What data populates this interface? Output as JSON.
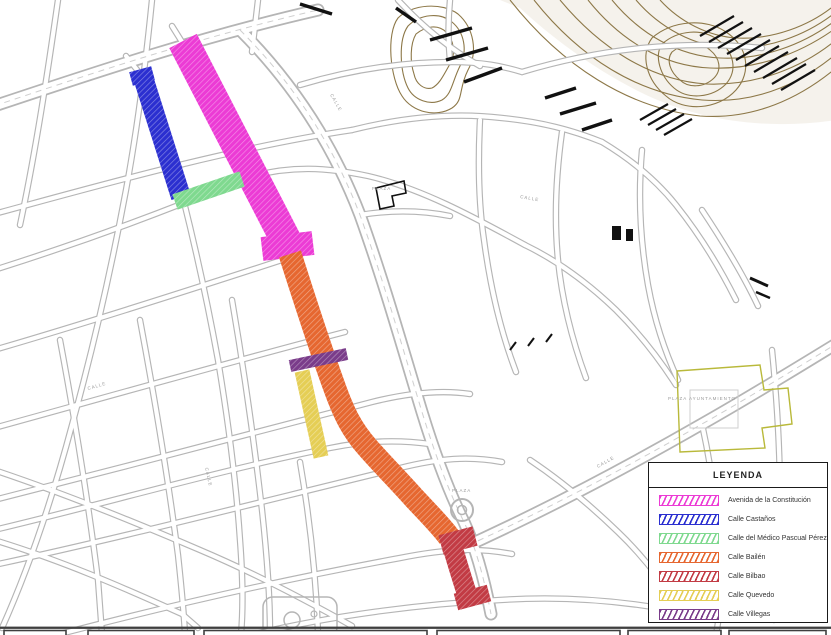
{
  "legend": {
    "title": "LEYENDA",
    "entries": [
      {
        "label": "Avenida de la Constitución",
        "color": "#EC3BD5"
      },
      {
        "label": "Calle Castaños",
        "color": "#2B2FD0"
      },
      {
        "label": "Calle del Médico Pascual Pérez",
        "color": "#7FD98F"
      },
      {
        "label": "Calle Bailén",
        "color": "#E66730"
      },
      {
        "label": "Calle Bilbao",
        "color": "#C23B44"
      },
      {
        "label": "Calle Quevedo",
        "color": "#E5CE55"
      },
      {
        "label": "Calle Villegas",
        "color": "#7A3C8A"
      }
    ]
  },
  "map": {
    "highlighted_streets": [
      {
        "id": "avenida-constitucion",
        "name": "Avenida de la Constitución",
        "color": "#EC3BD5",
        "path": "M 183 41 L 292 252",
        "width": 31,
        "extras": [
          {
            "path": "M 262 249 L 313 243",
            "width": 24
          }
        ]
      },
      {
        "id": "calle-castanos",
        "name": "Calle Castaños",
        "color": "#2B2FD0",
        "path": "M 142 74 L 181 197",
        "width": 20,
        "extras": [
          {
            "path": "M 131 79 L 153 73",
            "width": 14
          }
        ]
      },
      {
        "id": "calle-medico-pascual-perez",
        "name": "Calle del Médico Pascual Pérez",
        "color": "#7FD98F",
        "path": "M 175 202 L 242 179",
        "width": 16
      },
      {
        "id": "calle-bailen",
        "name": "Calle Bailén",
        "color": "#E66730",
        "path": "M 290 254 C 304 298 318 342 334 386 C 344 414 352 430 368 448 C 382 464 398 480 414 498 C 428 513 441 526 449 537",
        "width": 23
      },
      {
        "id": "calle-bilbao",
        "name": "Calle Bilbao",
        "color": "#C23B44",
        "path": "M 449 536 C 456 558 462 580 471 606",
        "width": 20,
        "extras": [
          {
            "path": "M 441 545 L 475 536",
            "width": 20
          },
          {
            "path": "M 456 602 L 489 593",
            "width": 17
          }
        ]
      },
      {
        "id": "calle-quevedo",
        "name": "Calle Quevedo",
        "color": "#E5CE55",
        "path": "M 302 371 L 321 457",
        "width": 15
      },
      {
        "id": "calle-villegas",
        "name": "Calle Villegas",
        "color": "#7A3C8A",
        "path": "M 290 366 L 347 354",
        "width": 12
      }
    ],
    "labels": [
      {
        "text": "CALLE",
        "x": 88,
        "y": 390,
        "rot": -16
      },
      {
        "text": "CALLE",
        "x": 205,
        "y": 468,
        "rot": 77
      },
      {
        "text": "CALLE",
        "x": 330,
        "y": 95,
        "rot": 60
      },
      {
        "text": "CALLE",
        "x": 520,
        "y": 198,
        "rot": 10
      },
      {
        "text": "CALLE",
        "x": 598,
        "y": 468,
        "rot": -30
      },
      {
        "text": "PLAZA",
        "x": 452,
        "y": 492,
        "rot": 0
      },
      {
        "text": "PLAZA",
        "x": 372,
        "y": 190,
        "rot": 0
      },
      {
        "text": "PLAZA  AYUNTAMIENTO",
        "x": 668,
        "y": 400,
        "rot": 0
      }
    ]
  }
}
